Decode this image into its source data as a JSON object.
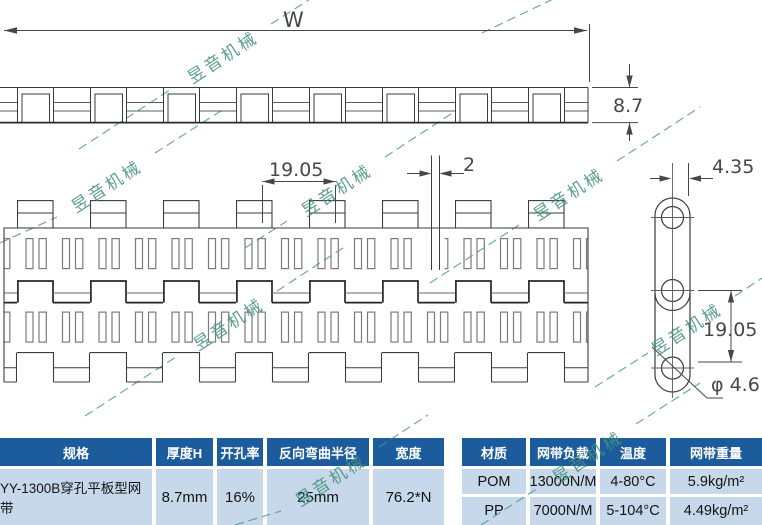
{
  "watermark": {
    "text": "昱音机械"
  },
  "drawing": {
    "dim_width_label": "W",
    "dim_thickness": "8.7",
    "dim_pitch_plan": "19.05",
    "dim_joint_gap": "2",
    "dim_link_width": "4.35",
    "dim_link_pitch": "19.05",
    "dim_hole_diameter": "φ 4.6"
  },
  "table": {
    "headers": [
      "规格",
      "厚度H",
      "开孔率",
      "反向弯曲半径",
      "宽度",
      "材质",
      "网带负载",
      "温度",
      "网带重量"
    ],
    "spec": {
      "name": "YY-1300B穿孔平板型网带",
      "thickness": "8.7mm",
      "open_rate": "16%",
      "bend_radius": "25mm",
      "width": "76.2*N"
    },
    "materials": [
      {
        "material": "POM",
        "load": "13000N/M",
        "temperature": "4-80°C",
        "weight": "5.9kg/m²"
      },
      {
        "material": "PP",
        "load": "7000N/M",
        "temperature": "5-104°C",
        "weight": "4.49kg/m²"
      }
    ]
  },
  "colors": {
    "header_bg": "#1c5c9c",
    "body_bg": "#c6d8ea",
    "watermark": "#44917f",
    "line": "#3b3b3b"
  }
}
